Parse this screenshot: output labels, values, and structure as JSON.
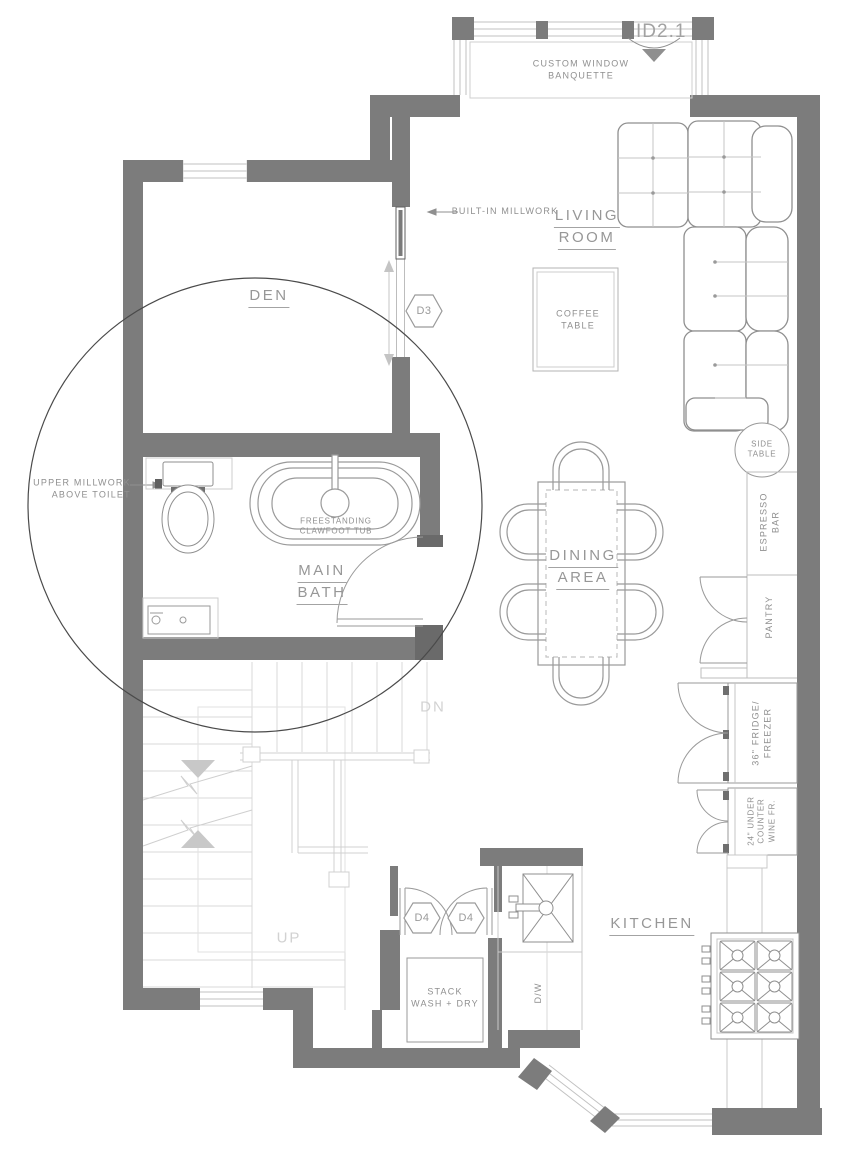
{
  "colors": {
    "wall": "#7c7c7c",
    "wall_dark": "#6a6a6a",
    "fixture_line": "#8f8f8f",
    "light_line": "#c6c6c6",
    "stair_line": "#d8d8d8",
    "text": "#8f8f8f",
    "faint_text": "#d2d2d2",
    "detail_circle": "#4a4a4a"
  },
  "sheet_tag": {
    "label": "ID2.1"
  },
  "rooms": {
    "living_room": [
      "LIVING",
      "ROOM"
    ],
    "den": [
      "DEN"
    ],
    "main_bath": [
      "MAIN",
      "BATH"
    ],
    "dining_area": [
      "DINING",
      "AREA"
    ],
    "kitchen": [
      "KITCHEN"
    ]
  },
  "door_tags": {
    "d3": "D3",
    "d4_left": "D4",
    "d4_right": "D4"
  },
  "annotations": {
    "banquette": [
      "CUSTOM WINDOW",
      "BANQUETTE"
    ],
    "built_in_millwork": "BUILT-IN MILLWORK",
    "upper_millwork": [
      "UPPER MILLWORK",
      "ABOVE TOILET"
    ],
    "coffee_table": [
      "COFFEE",
      "TABLE"
    ],
    "side_table": [
      "SIDE",
      "TABLE"
    ],
    "tub": [
      "FREESTANDING",
      "CLAWFOOT TUB"
    ],
    "espresso_bar": [
      "ESPRESSO",
      "BAR"
    ],
    "pantry": "PANTRY",
    "fridge": [
      "36\" FRIDGE/",
      "FREEZER"
    ],
    "wine_fridge": [
      "24\" UNDER",
      "COUNTER",
      "WINE FR."
    ],
    "stack_washer": [
      "STACK",
      "WASH + DRY"
    ],
    "dishwasher": "D/W",
    "stairs_dn": "DN",
    "stairs_up": "UP"
  }
}
